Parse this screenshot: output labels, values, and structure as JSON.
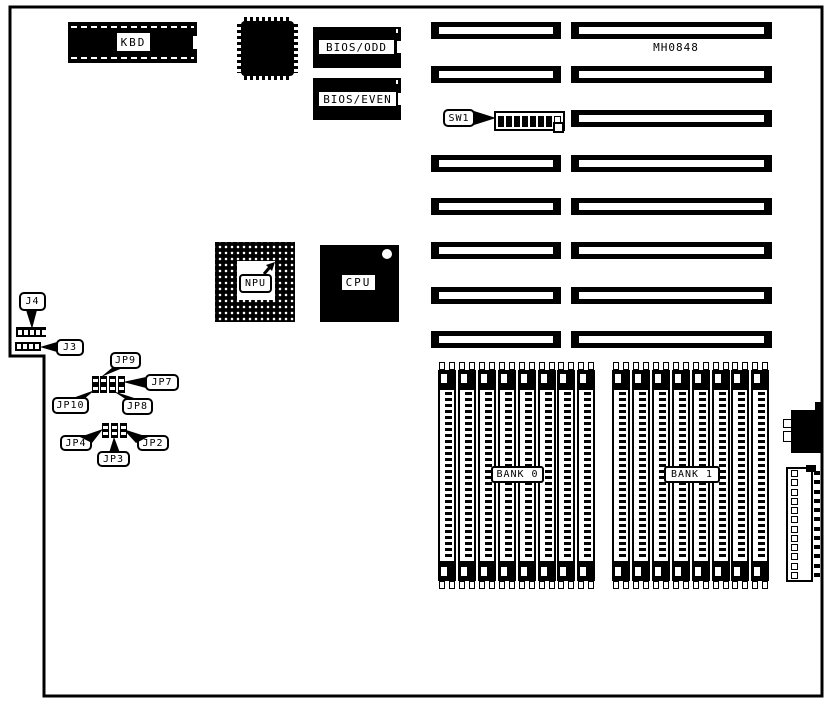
{
  "board": {
    "model_text": "MH0848"
  },
  "components": {
    "kbd": {
      "label": "KBD"
    },
    "bios_odd": {
      "label": "BIOS/ODD"
    },
    "bios_even": {
      "label": "BIOS/EVEN"
    },
    "sw1": {
      "label": "SW1",
      "positions": 8,
      "closed_count": 7
    },
    "npu": {
      "label": "NPU"
    },
    "cpu": {
      "label": "CPU"
    },
    "j4": {
      "label": "J4",
      "pins": 5
    },
    "j3": {
      "label": "J3",
      "pins": 4
    },
    "jp2": {
      "label": "JP2"
    },
    "jp3": {
      "label": "JP3"
    },
    "jp4": {
      "label": "JP4"
    },
    "jp7": {
      "label": "JP7"
    },
    "jp8": {
      "label": "JP8"
    },
    "jp9": {
      "label": "JP9"
    },
    "jp10": {
      "label": "JP10"
    }
  },
  "memory": {
    "banks": [
      {
        "label": "BANK 0",
        "sockets": 8
      },
      {
        "label": "BANK 1",
        "sockets": 8
      }
    ]
  },
  "expansion_slots": {
    "rows": 8
  },
  "power_connector": {
    "pins": 12
  },
  "colors": {
    "ink": "#000000",
    "paper": "#ffffff"
  }
}
